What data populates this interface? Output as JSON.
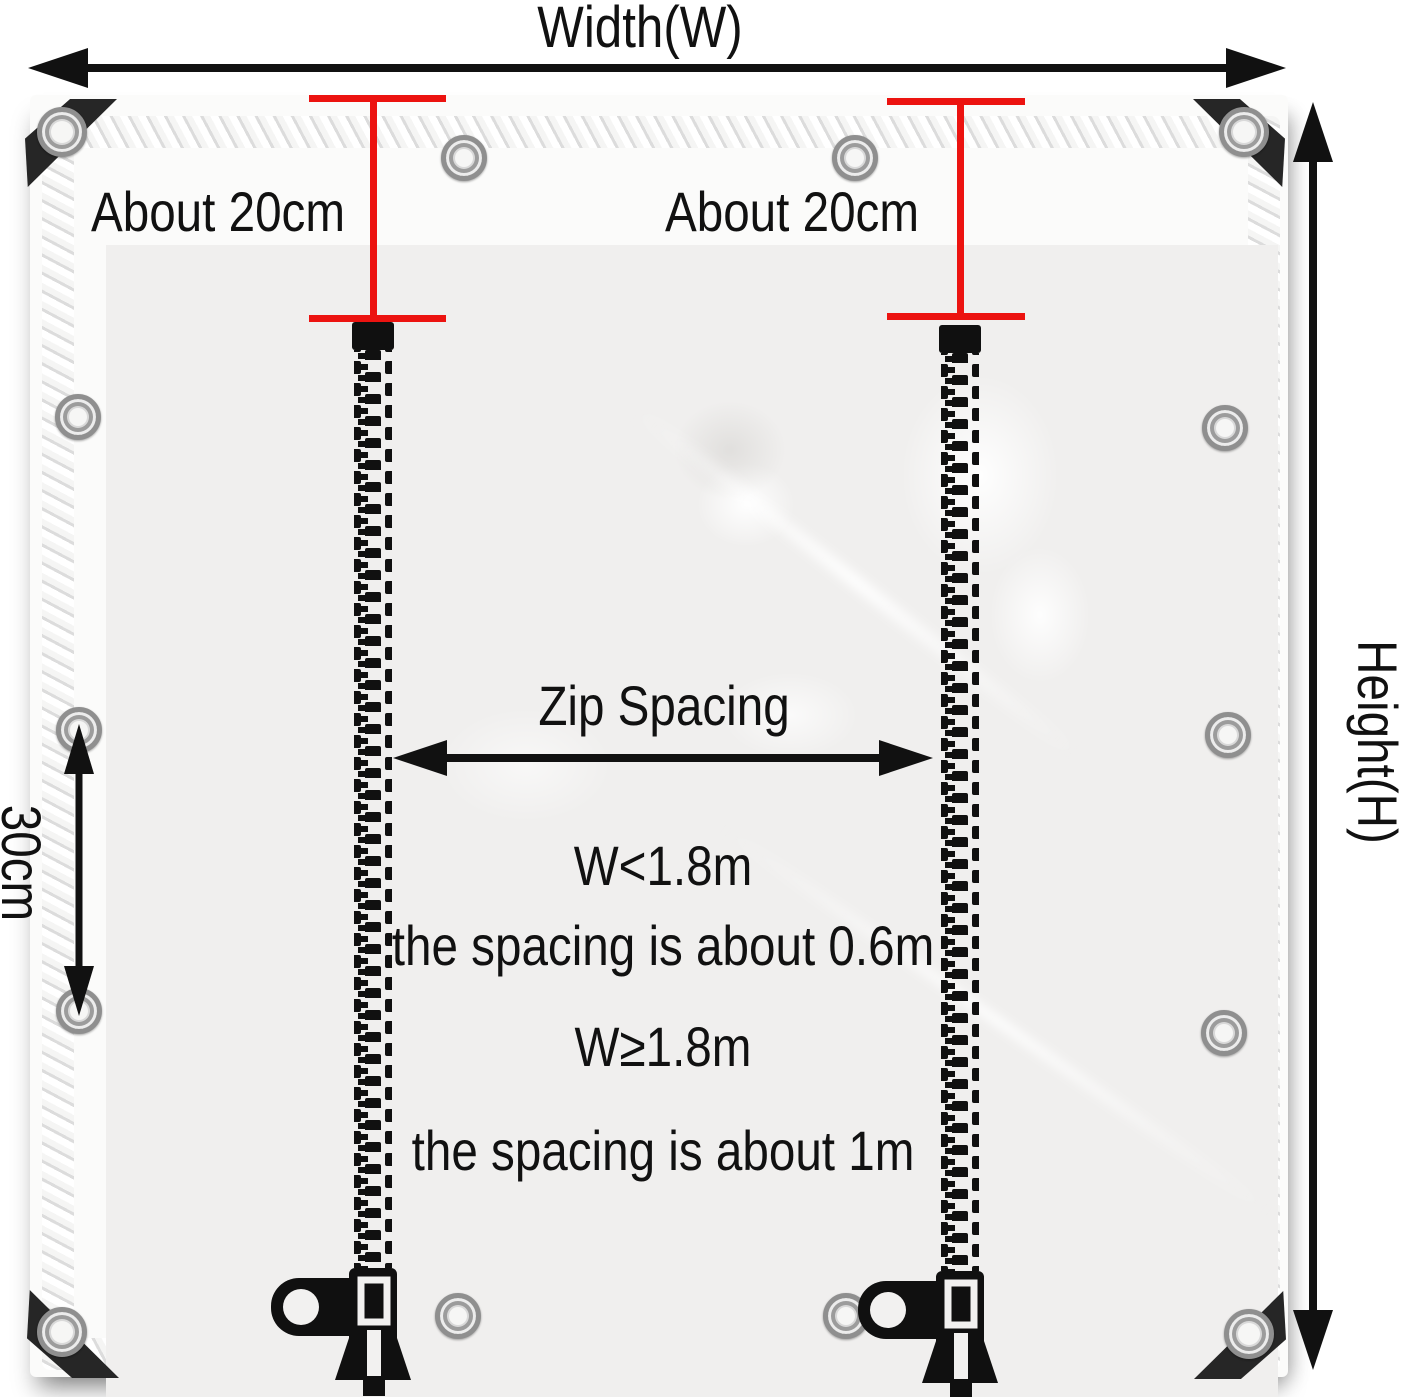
{
  "labels": {
    "width": "Width(W)",
    "height": "Height(H)",
    "offset_left": "About 20cm",
    "offset_right": "About 20cm",
    "grommet_spacing": "30cm",
    "zip_spacing": "Zip Spacing"
  },
  "spacing_rules": [
    {
      "condition": "W<1.8m",
      "result": "the spacing is about 0.6m"
    },
    {
      "condition": "W≥1.8m",
      "result": "the spacing is about 1m"
    }
  ],
  "colors": {
    "annotation_red": "#ec1310",
    "annotation_black": "#111111",
    "tarp_surface": "#f0efee",
    "corner_patch": "#262626",
    "grommet_silver": "#9a9a9a"
  },
  "icons": {
    "grommet": "metal-eyelet-ring",
    "zipper": "vertical-zipper-teeth",
    "zipper_pull": "zipper-slider-with-tab",
    "arrows": "double-headed-measurement-arrow"
  }
}
